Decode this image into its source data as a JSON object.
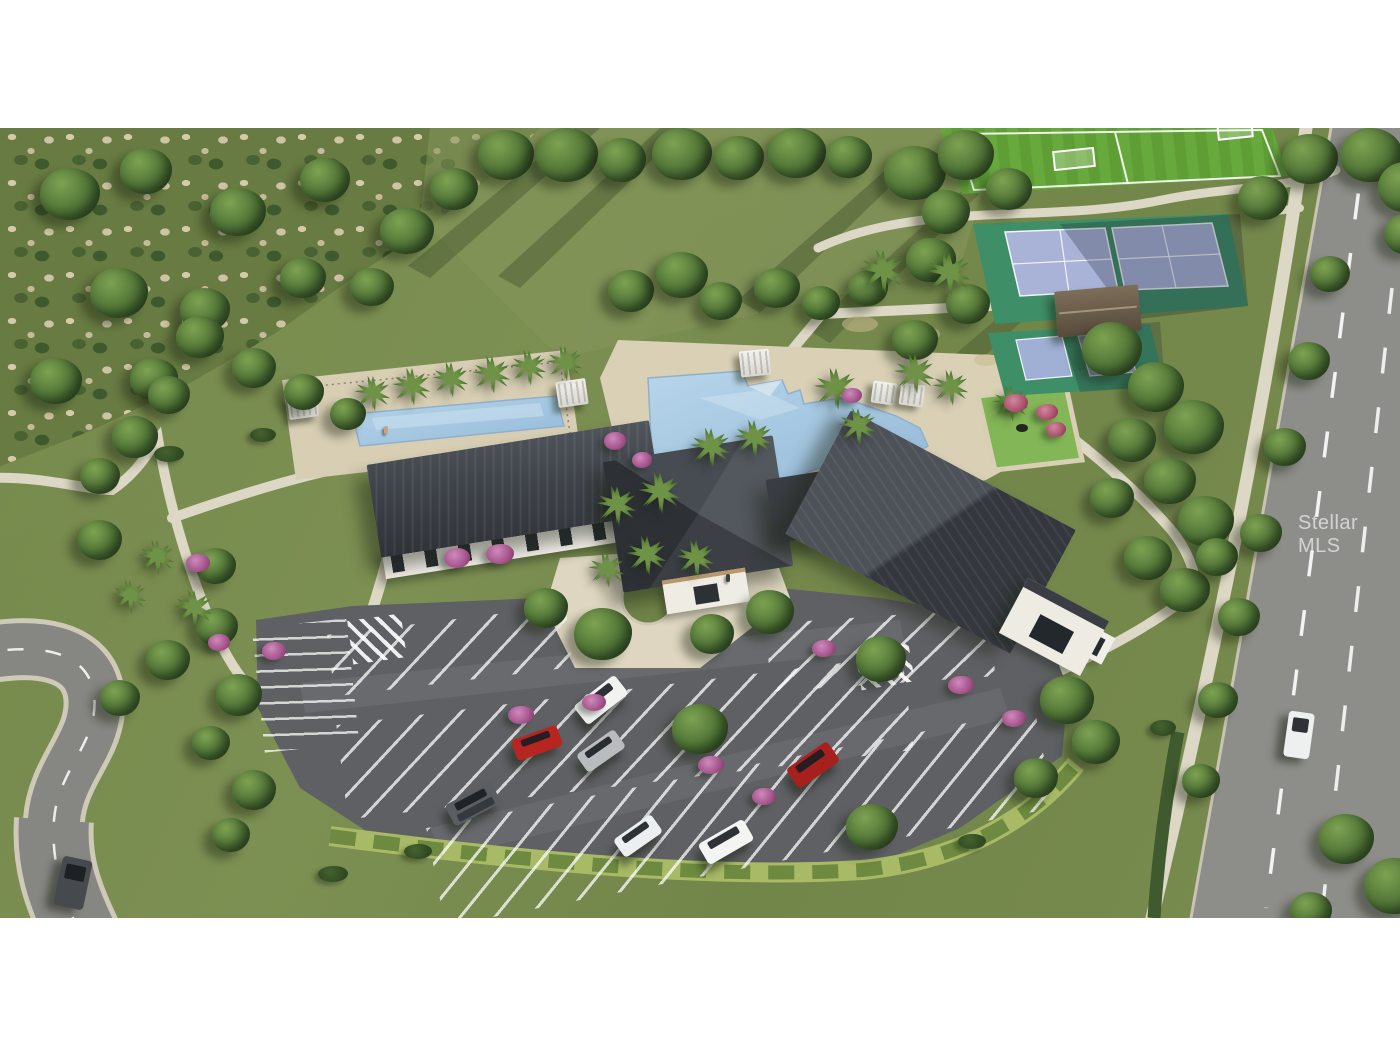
{
  "watermark": {
    "text": "Stellar MLS"
  },
  "frame": {
    "background_color": "#ffffff"
  },
  "scene": {
    "description": "Aerial 3D rendering of a residential community amenity center",
    "objects": [
      "clubhouse",
      "resort-pool",
      "lap-pool",
      "pool-deck",
      "cabanas",
      "event-lawn",
      "tennis-courts",
      "pickleball-courts",
      "shade-pavilion",
      "soccer-field",
      "parking-lot",
      "crosswalks",
      "community-roads",
      "sidewalks",
      "preserve-scrub",
      "open-lawn",
      "street-trees",
      "palm-trees",
      "flowering-shrubs",
      "cars"
    ],
    "palette": {
      "grass": "#78894d",
      "scrub_tan": "#cfc3a2",
      "tree_green": "#4c6c34",
      "roof_charcoal": "#3b3f45",
      "building_white": "#f2efe8",
      "pool_water": "#a6c7e0",
      "deck_tan": "#d9d0b6",
      "road_gray": "#8d8d89",
      "parking_asphalt": "#5f6064",
      "court_surround_green": "#3e8e68",
      "court_surface_blue": "#a9b3d8",
      "turf_green": "#67a93c",
      "event_lawn_green": "#83b656",
      "hedge_green": "#a8ba66",
      "flower_pink": "#b06a9e",
      "line_white": "#ffffff",
      "watermark_white": "rgba(255,255,255,0.6)"
    }
  }
}
